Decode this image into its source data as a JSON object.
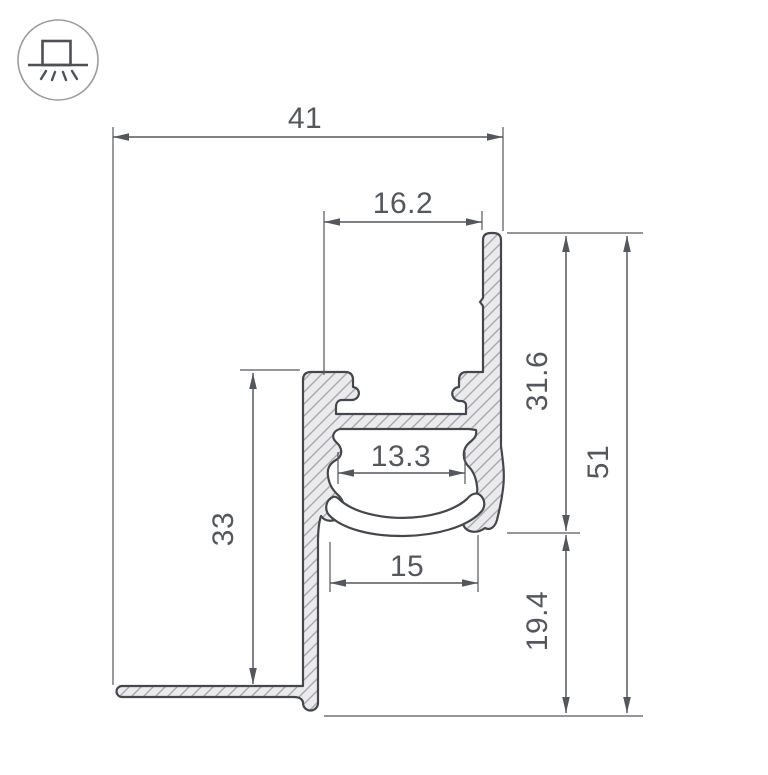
{
  "drawing": {
    "title": "LED profile cross-section technical drawing",
    "icon": {
      "name": "surface-mounted-profile",
      "meaning": "surface mount, light emitted downward"
    },
    "colors": {
      "outline": "#44484d",
      "dimension": "#54585c",
      "hatch_fill": "#ebebed",
      "hatch_line": "#a6a8ab",
      "background": "#ffffff"
    }
  },
  "dimensions": {
    "overall_width": "41",
    "top_opening_width": "16.2",
    "upper_right_height": "31.6",
    "overall_height": "51",
    "inner_channel_width": "13.3",
    "left_body_height": "33",
    "diffuser_width": "15",
    "lower_right_height": "19.4"
  }
}
